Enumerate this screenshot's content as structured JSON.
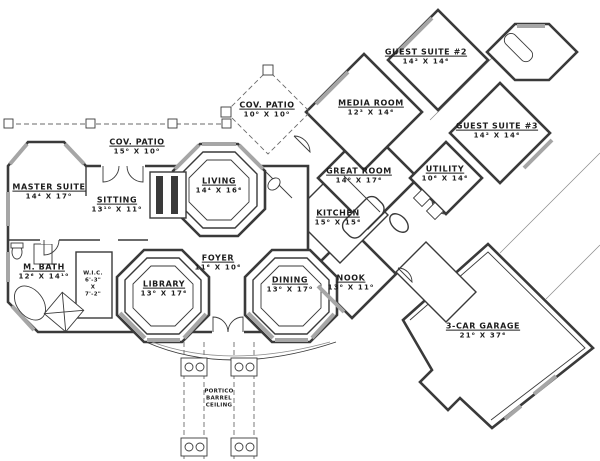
{
  "drawing": {
    "kind": "residential floor plan",
    "colors": {
      "ink": "#3a3a3a",
      "paper": "#ffffff",
      "window_hatch": "#a6a6a6"
    }
  },
  "rooms": {
    "cov_patio_left": {
      "label": "COV. PATIO",
      "dims": "15⁰ X 10⁰"
    },
    "master_suite": {
      "label": "MASTER SUITE",
      "dims": "14⁴ X 17⁰"
    },
    "sitting": {
      "label": "SITTING",
      "dims": "13¹⁰ X 11⁰"
    },
    "living": {
      "label": "LIVING",
      "dims": "14⁴ X 16⁶"
    },
    "cov_patio_center": {
      "label": "COV. PATIO",
      "dims": "10⁰ X 10⁰"
    },
    "media_room": {
      "label": "MEDIA ROOM",
      "dims": "12³ X 14⁶"
    },
    "guest_suite_2": {
      "label": "GUEST SUITE #2",
      "dims": "14² X 14⁶"
    },
    "guest_suite_3": {
      "label": "GUEST SUITE #3",
      "dims": "14² X 14⁶"
    },
    "utility": {
      "label": "UTILITY",
      "dims": "10⁶ X 14⁶"
    },
    "great_room": {
      "label": "GREAT ROOM",
      "dims": "14⁰ X 17⁶"
    },
    "kitchen": {
      "label": "KITCHEN",
      "dims": "15⁰ X 15⁶"
    },
    "m_bath": {
      "label": "M. BATH",
      "dims": "12⁶ X 14¹⁰"
    },
    "library": {
      "label": "LIBRARY",
      "dims": "13⁰ X 17⁶"
    },
    "foyer": {
      "label": "FOYER",
      "dims": "11⁶ X 10⁶"
    },
    "dining": {
      "label": "DINING",
      "dims": "13⁰ X 17⁰"
    },
    "nook": {
      "label": "NOOK",
      "dims": "13⁰ X 11⁰"
    },
    "garage": {
      "label": "3-CAR GARAGE",
      "dims": "21⁰ X 37⁶"
    }
  },
  "annotations": {
    "wic": {
      "text": "W.I.C.\n6'-3\"\nX\n7'-2\""
    },
    "portico": {
      "text": "PORTICO\nBARREL\nCEILING"
    }
  }
}
